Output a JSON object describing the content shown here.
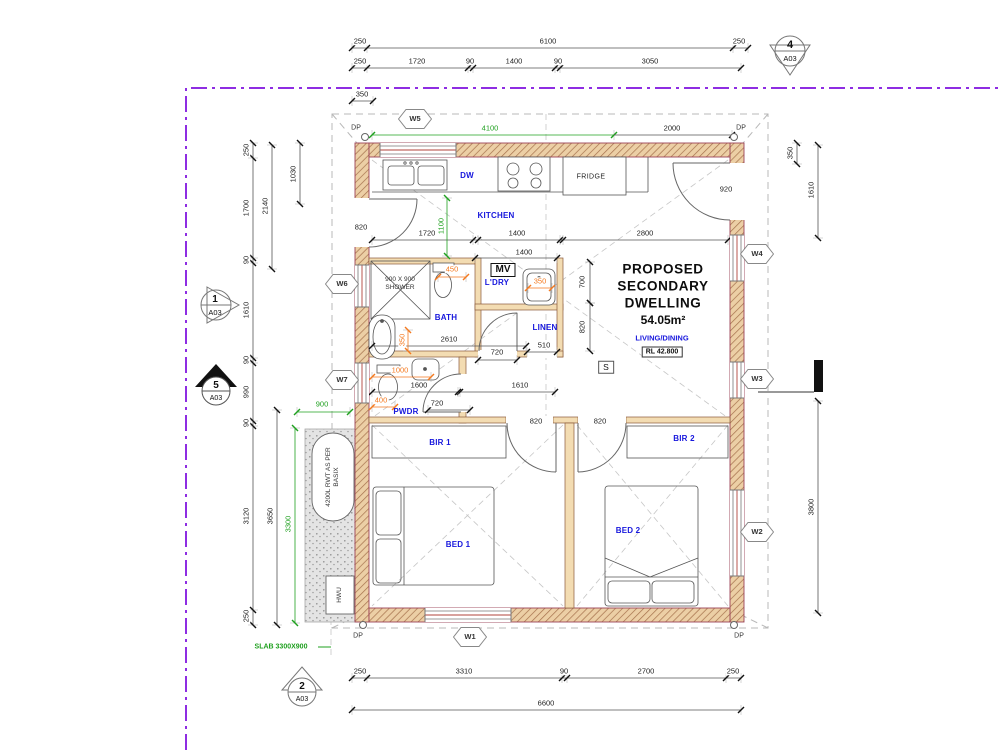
{
  "drawing": {
    "title_lines": [
      "PROPOSED",
      "SECONDARY",
      "DWELLING"
    ],
    "area_label": "54.05m²",
    "zone_label": "LIVING/DINING",
    "rl_label": "RL 42.800",
    "smoke_label": "S",
    "mv_label": "MV",
    "shower_note": "900 X 900 SHOWER",
    "rwt_note": "4200L RWT AS PER BASIX",
    "hwu_label": "HWU",
    "slab_note": "SLAB 3300X900",
    "dp_label": "DP"
  },
  "colors": {
    "boundary_purple": "#8e2de2",
    "dim_green": "#1fa01f",
    "dim_orange": "#f4791f",
    "label_blue": "#1717dd",
    "wall_tan": "#f3dcb2"
  },
  "room_labels": [
    {
      "t": "KITCHEN",
      "x": 496,
      "y": 216
    },
    {
      "t": "DW",
      "x": 467,
      "y": 176
    },
    {
      "t": "FRIDGE",
      "x": 591,
      "y": 177,
      "cls": "k"
    },
    {
      "t": "BATH",
      "x": 446,
      "y": 318
    },
    {
      "t": "L'DRY",
      "x": 497,
      "y": 283
    },
    {
      "t": "LINEN",
      "x": 545,
      "y": 328
    },
    {
      "t": "PWDR",
      "x": 406,
      "y": 412
    },
    {
      "t": "BIR 1",
      "x": 440,
      "y": 443
    },
    {
      "t": "BIR 2",
      "x": 684,
      "y": 439
    },
    {
      "t": "BED 1",
      "x": 458,
      "y": 545
    },
    {
      "t": "BED 2",
      "x": 628,
      "y": 531
    }
  ],
  "window_tags": [
    {
      "label": "W5",
      "x": 415,
      "y": 119
    },
    {
      "label": "W6",
      "x": 342,
      "y": 284
    },
    {
      "label": "W7",
      "x": 342,
      "y": 380
    },
    {
      "label": "W1",
      "x": 470,
      "y": 637
    },
    {
      "label": "W4",
      "x": 757,
      "y": 254
    },
    {
      "label": "W3",
      "x": 757,
      "y": 379
    },
    {
      "label": "W2",
      "x": 757,
      "y": 532
    }
  ],
  "drawing_refs": [
    {
      "num": "4",
      "sheet": "A03",
      "shape": "down",
      "x": 790,
      "y": 60
    },
    {
      "num": "1",
      "sheet": "A03",
      "shape": "right",
      "x": 222,
      "y": 307
    },
    {
      "num": "5",
      "sheet": "A03",
      "shape": "up_filled",
      "x": 216,
      "y": 386
    },
    {
      "num": "2",
      "sheet": "A03",
      "shape": "up",
      "x": 302,
      "y": 688
    }
  ],
  "downpipes": [
    {
      "x": 365,
      "y": 138,
      "lx": 356,
      "ly": 128
    },
    {
      "x": 734,
      "y": 138,
      "lx": 741,
      "ly": 128
    },
    {
      "x": 363,
      "y": 626,
      "lx": 358,
      "ly": 636
    },
    {
      "x": 734,
      "y": 626,
      "lx": 739,
      "ly": 636
    }
  ],
  "dimensions": [
    {
      "t": "250",
      "x": 360,
      "y": 41
    },
    {
      "t": "6100",
      "x": 548,
      "y": 41
    },
    {
      "t": "250",
      "x": 739,
      "y": 41
    },
    {
      "t": "250",
      "x": 360,
      "y": 61
    },
    {
      "t": "1720",
      "x": 417,
      "y": 61
    },
    {
      "t": "90",
      "x": 470,
      "y": 61
    },
    {
      "t": "1400",
      "x": 514,
      "y": 61
    },
    {
      "t": "90",
      "x": 558,
      "y": 61
    },
    {
      "t": "3050",
      "x": 650,
      "y": 61
    },
    {
      "t": "350",
      "x": 362,
      "y": 94
    },
    {
      "t": "4100",
      "x": 490,
      "y": 128,
      "cls": "g"
    },
    {
      "t": "2000",
      "x": 672,
      "y": 128
    },
    {
      "t": "250",
      "x": 360,
      "y": 671
    },
    {
      "t": "3310",
      "x": 464,
      "y": 671
    },
    {
      "t": "90",
      "x": 564,
      "y": 671
    },
    {
      "t": "2700",
      "x": 646,
      "y": 671
    },
    {
      "t": "250",
      "x": 733,
      "y": 671
    },
    {
      "t": "6600",
      "x": 546,
      "y": 703
    },
    {
      "t": "250",
      "x": 246,
      "y": 150,
      "rot": 1
    },
    {
      "t": "1700",
      "x": 246,
      "y": 208,
      "rot": 1
    },
    {
      "t": "90",
      "x": 246,
      "y": 260,
      "rot": 1
    },
    {
      "t": "1610",
      "x": 246,
      "y": 310,
      "rot": 1
    },
    {
      "t": "90",
      "x": 246,
      "y": 360,
      "rot": 1
    },
    {
      "t": "990",
      "x": 246,
      "y": 392,
      "rot": 1
    },
    {
      "t": "90",
      "x": 246,
      "y": 423,
      "rot": 1
    },
    {
      "t": "3120",
      "x": 246,
      "y": 516,
      "rot": 1
    },
    {
      "t": "250",
      "x": 246,
      "y": 616,
      "rot": 1
    },
    {
      "t": "2140",
      "x": 265,
      "y": 206,
      "rot": 1
    },
    {
      "t": "1030",
      "x": 293,
      "y": 174,
      "rot": 1
    },
    {
      "t": "3650",
      "x": 270,
      "y": 516,
      "rot": 1
    },
    {
      "t": "3300",
      "x": 288,
      "y": 524,
      "rot": 1,
      "cls": "g"
    },
    {
      "t": "900",
      "x": 322,
      "y": 404,
      "cls": "g"
    },
    {
      "t": "350",
      "x": 790,
      "y": 153,
      "rot": 1
    },
    {
      "t": "1610",
      "x": 811,
      "y": 190,
      "rot": 1
    },
    {
      "t": "3800",
      "x": 811,
      "y": 507,
      "rot": 1
    },
    {
      "t": "820",
      "x": 361,
      "y": 227
    },
    {
      "t": "1720",
      "x": 427,
      "y": 233
    },
    {
      "t": "1400",
      "x": 517,
      "y": 233
    },
    {
      "t": "2800",
      "x": 645,
      "y": 233
    },
    {
      "t": "920",
      "x": 726,
      "y": 189
    },
    {
      "t": "1100",
      "x": 441,
      "y": 226,
      "rot": 1,
      "cls": "g"
    },
    {
      "t": "1400",
      "x": 524,
      "y": 252
    },
    {
      "t": "450",
      "x": 452,
      "y": 269,
      "cls": "o"
    },
    {
      "t": "350",
      "x": 540,
      "y": 281,
      "cls": "o"
    },
    {
      "t": "700",
      "x": 582,
      "y": 282,
      "rot": 1
    },
    {
      "t": "820",
      "x": 582,
      "y": 327,
      "rot": 1
    },
    {
      "t": "2610",
      "x": 449,
      "y": 339
    },
    {
      "t": "510",
      "x": 544,
      "y": 345
    },
    {
      "t": "720",
      "x": 497,
      "y": 352
    },
    {
      "t": "350",
      "x": 402,
      "y": 340,
      "rot": 1,
      "cls": "o"
    },
    {
      "t": "1000",
      "x": 400,
      "y": 370,
      "cls": "o"
    },
    {
      "t": "1600",
      "x": 419,
      "y": 385
    },
    {
      "t": "400",
      "x": 381,
      "y": 400,
      "cls": "o"
    },
    {
      "t": "720",
      "x": 437,
      "y": 403
    },
    {
      "t": "1610",
      "x": 520,
      "y": 385
    },
    {
      "t": "820",
      "x": 536,
      "y": 421
    },
    {
      "t": "820",
      "x": 600,
      "y": 421
    }
  ]
}
